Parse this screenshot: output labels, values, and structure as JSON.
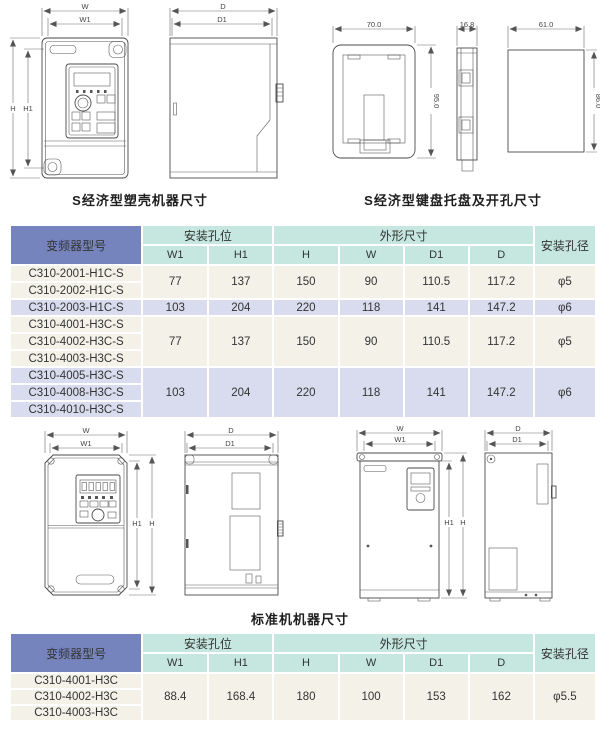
{
  "captions": {
    "econ_case": "S经济型塑壳机器尺寸",
    "keypad_tray": "S经济型键盘托盘及开孔尺寸",
    "standard": "标准机机器尺寸"
  },
  "dims": {
    "w": "W",
    "w1": "W1",
    "h": "H",
    "h1": "H1",
    "d": "D",
    "d1": "D1",
    "tray_width": "70.0",
    "tray_height": "95.0",
    "tray_depth": "16.8",
    "hole_width": "61.0",
    "hole_height": "86.0"
  },
  "tables": {
    "header": {
      "model": "变频器型号",
      "mounting_holes": "安装孔位",
      "outline": "外形尺寸",
      "hole_diameter": "安装孔径",
      "sub_columns": [
        "W1",
        "H1",
        "H",
        "W",
        "D1",
        "D"
      ]
    },
    "economic": {
      "groups": [
        {
          "tone": "cream",
          "models": [
            "C310-2001-H1C-S",
            "C310-2002-H1C-S"
          ],
          "values": [
            "77",
            "137",
            "150",
            "90",
            "110.5",
            "117.2",
            "φ5"
          ]
        },
        {
          "tone": "lavender",
          "models": [
            "C310-2003-H1C-S"
          ],
          "values": [
            "103",
            "204",
            "220",
            "118",
            "141",
            "147.2",
            "φ6"
          ]
        },
        {
          "tone": "cream",
          "models": [
            "C310-4001-H3C-S",
            "C310-4002-H3C-S",
            "C310-4003-H3C-S"
          ],
          "values": [
            "77",
            "137",
            "150",
            "90",
            "110.5",
            "117.2",
            "φ5"
          ]
        },
        {
          "tone": "lavender",
          "models": [
            "C310-4005-H3C-S",
            "C310-4008-H3C-S",
            "C310-4010-H3C-S"
          ],
          "values": [
            "103",
            "204",
            "220",
            "118",
            "141",
            "147.2",
            "φ6"
          ]
        }
      ]
    },
    "standard": {
      "groups": [
        {
          "tone": "cream",
          "models": [
            "C310-4001-H3C",
            "C310-4002-H3C",
            "C310-4003-H3C"
          ],
          "values": [
            "88.4",
            "168.4",
            "180",
            "100",
            "153",
            "162",
            "φ5.5"
          ]
        }
      ]
    }
  },
  "colors": {
    "header_model_bg": "#7584bd",
    "header_teal_bg": "#c5e7df",
    "row_cream_bg": "#f4f2e8",
    "row_lavender_bg": "#d9dcee",
    "line": "#4a4a4a"
  }
}
